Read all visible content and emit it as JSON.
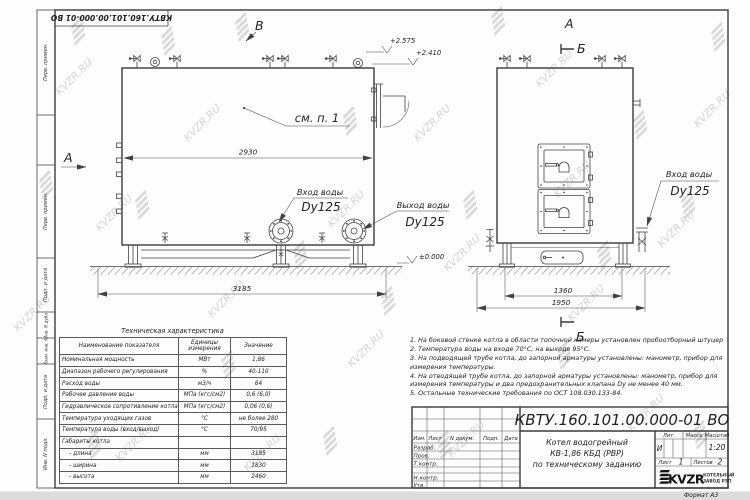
{
  "watermark": {
    "text": "KVZR.RU"
  },
  "stamp_top": "КВТУ.160.101.00.000-01 ВО",
  "sidebar": {
    "cells": [
      "Перв. примен.",
      "",
      "Перв. примен.",
      "Подп. и дата",
      "Инв. N дубл.",
      "Взам. инв. N",
      "Подп. и дата",
      "Инв. N подл."
    ]
  },
  "left_view": {
    "view_label_top": "В",
    "view_label_side": "А",
    "elevation_top": "+2.575",
    "elevation_mid": "+2.410",
    "elevation_zero": "±0.000",
    "callout": "см. п. 1",
    "dim_body": "2930",
    "dim_overall": "3185",
    "inlet": {
      "line1": "Вход воды",
      "line2": "Dy125"
    },
    "outlet": {
      "line1": "Выход воды",
      "line2": "Dy125"
    }
  },
  "right_view": {
    "view_label": "А",
    "section_top": "Б",
    "section_bottom": "Б",
    "dim_inner": "1360",
    "dim_overall": "1950",
    "inlet": {
      "line1": "Вход воды",
      "line2": "Dy125"
    }
  },
  "spec_table": {
    "title": "Техническая характеристика",
    "col_name": "Наименование показателя",
    "col_units": "Единицы измерения",
    "col_value": "Значение",
    "rows": [
      {
        "name": "Номинальная мощность",
        "units": "МВт",
        "value": "1,86"
      },
      {
        "name": "Диапазон рабочего регулирования",
        "units": "%",
        "value": "40-110"
      },
      {
        "name": "Расход воды",
        "units": "м3/ч",
        "value": "64"
      },
      {
        "name": "Рабочее давление воды",
        "units": "МПа (кгс/см2)",
        "value": "0,6 (6,0)"
      },
      {
        "name": "Гидравлическое сопротивление котла",
        "units": "МПа (кгс/см2)",
        "value": "0,06 (0,6)"
      },
      {
        "name": "Температура уходящих газов",
        "units": "°С",
        "value": "не более 280"
      },
      {
        "name": "Температура воды (вход/выход)",
        "units": "°С",
        "value": "70/95"
      },
      {
        "name": "Габариты котла",
        "units": "",
        "value": ""
      },
      {
        "name": "    - длина",
        "units": "мм",
        "value": "3185"
      },
      {
        "name": "    - ширина",
        "units": "мм",
        "value": "1830"
      },
      {
        "name": "    - высота",
        "units": "мм",
        "value": "2460"
      }
    ]
  },
  "notes": [
    "1. На боковой стенке котла в области топочной камеры установлен пробоотборный штуцер",
    "2. Температура воды на входе 70°С, на выходе 95°С.",
    "3. На подводящей трубе котла, до запорной арматуры установлены: манометр, прибор для измерения температуры.",
    "4. На отводящей трубе котла, до запорной арматуры установлены: манометр, прибор для измерения температуры и два предохранительных клапана Dу не менее 40 мм.",
    "5. Остальные технические требования по ОСТ 108.030.133-84."
  ],
  "title_block": {
    "doc_number": "КВТУ.160.101.00.000-01 ВО",
    "rev_cols": [
      "Изм.",
      "Лист",
      "N докум.",
      "Подп.",
      "Дата"
    ],
    "roles": [
      "Разраб.",
      "Пров.",
      "Т.контр.",
      "Н.контр.",
      "Утв."
    ],
    "product": [
      "Котел водогрейный",
      "КВ-1,86 КБД (РВР)",
      "по техническому заданию"
    ],
    "lit_label": "Лит.",
    "mass_label": "Масса",
    "scale_label": "Масштаб",
    "lit_value": "И",
    "scale_value": "1:20",
    "sheet_label": "Лист",
    "sheet_value": "1",
    "sheets_label": "Листов",
    "sheets_value": "2",
    "logo_text": "KVZR",
    "company_line1": "КОТЕЛЬНЫЙ",
    "company_line2": "ЗАВОД РЭП",
    "format": "Формат  А3"
  }
}
